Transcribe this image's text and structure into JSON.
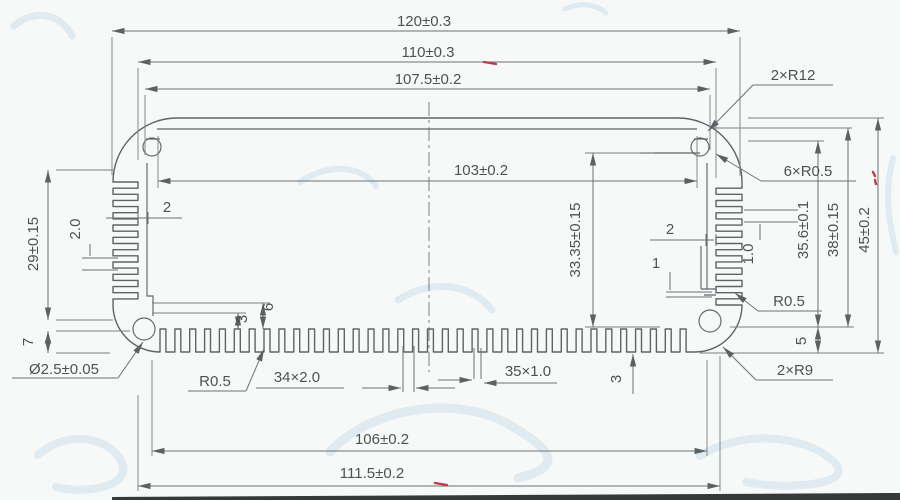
{
  "drawing_type": "extrusion-profile-cross-section",
  "colors": {
    "background": "#f7f9f8",
    "line": "#5e6466",
    "dim_line": "#6b7173",
    "text": "#4c5254",
    "red_mark": "#c03a4a",
    "watermark": "#c9dcea",
    "photo_edge": "#1c1c1c"
  },
  "dimensions": {
    "top": {
      "overall": "120±0.3",
      "body": "110±0.3",
      "step": "107.5±0.2"
    },
    "center": {
      "cavity_width": "103±0.2",
      "cavity_height": "33.35±0.15"
    },
    "left": {
      "fin_height": "29±0.15",
      "corner": "7",
      "fin_pitch": "2.0",
      "wall": "2",
      "step6": "6",
      "step3": "3",
      "hole": "Ø2.5±0.05"
    },
    "bottom": {
      "fin_radius": "R0.5",
      "slots": "34×2.0",
      "ribs": "35×1.0",
      "depth": "3",
      "inner_width": "106±0.2",
      "outer_width": "111.5±0.2"
    },
    "right": {
      "corner_top": "2×R12",
      "fillets": "6×R0.5",
      "wall": "2",
      "rib": "1",
      "fin_pitch": "1.0",
      "fin_radius": "R0.5",
      "height_inner": "35.6±0.1",
      "height_mid": "38±0.15",
      "height_overall": "45±0.2",
      "corner_height": "5",
      "corner_bottom": "2×R9"
    }
  }
}
